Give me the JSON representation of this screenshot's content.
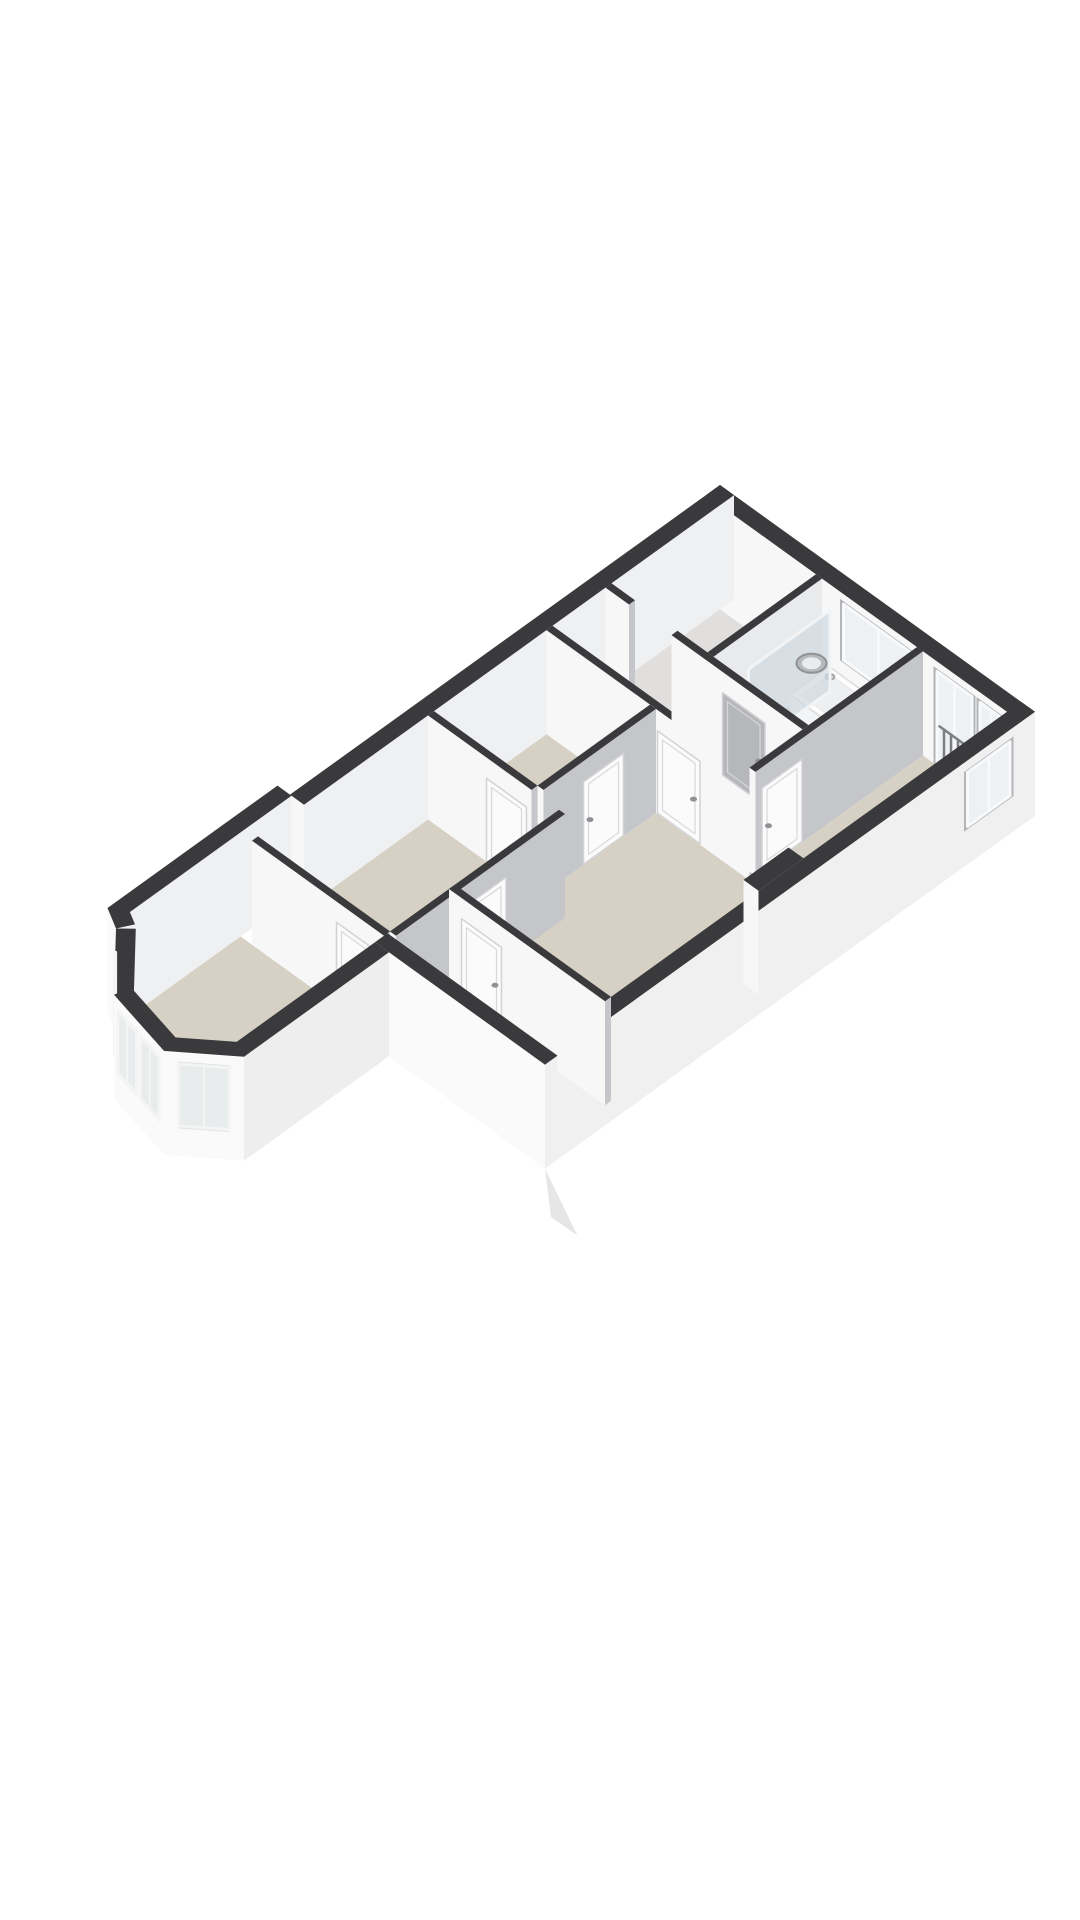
{
  "meta": {
    "type": "3d-floorplan-dollhouse-render",
    "view": "axonometric cutaway of one dwelling floor",
    "background": "#ffffff"
  },
  "palette": {
    "wall_top": "#3a3a3d",
    "wall_face_bright": "#f7f7f8",
    "wall_face_shaded": "#c5c6c9",
    "exterior_face": "#fafafa",
    "exterior_side": "#f0f0f1",
    "floor_room": "#d6d1c4",
    "floor_hall": "#e0dfdd",
    "floor_loggia": "#dadad8",
    "window_glass": "#eef1f3",
    "window_frame": "#f8f9fa",
    "window_surround": "#b4b5b8",
    "door_white": "#fbfbfc",
    "door_gray": "#b6b7ba",
    "tub_white": "#fdfdfe",
    "tub_inner": "#edeff1",
    "screen_glass": "rgba(208,217,224,0.72)"
  },
  "floorplan": {
    "projection": {
      "ox": 720,
      "oy": 589,
      "s": 50,
      "vy": 36,
      "hz": 40
    },
    "rooms": [
      {
        "id": "stairwell",
        "floor": "#e0dfdd"
      },
      {
        "id": "bathroom",
        "floor": "#d6d1c4"
      },
      {
        "id": "rear-bedroom",
        "floor": "#d6d1c4"
      },
      {
        "id": "landing-hall",
        "floor": "#e0dfdd"
      },
      {
        "id": "left-room",
        "floor": "#d6d1c4"
      },
      {
        "id": "center-bedroom",
        "floor": "#d6d1c4"
      },
      {
        "id": "front-middle-room",
        "floor": "#d6d1c4"
      },
      {
        "id": "loggia-roof-terrace",
        "floor": "#dadad8"
      },
      {
        "id": "bay-window-room",
        "floor": "#d6d1c4"
      }
    ],
    "floors": [
      {
        "id": "floor-stairwell",
        "color": "#e0dfdd",
        "pts": [
          [
            0.28,
            0.28
          ],
          [
            0.28,
            2.2
          ],
          [
            2.45,
            2.2
          ],
          [
            2.45,
            0.28
          ]
        ]
      },
      {
        "id": "floor-threshold",
        "color": "#e0dfdd",
        "pts": [
          [
            2.45,
            0.75
          ],
          [
            2.45,
            1.6
          ],
          [
            2.57,
            1.6
          ],
          [
            2.57,
            0.75
          ]
        ]
      },
      {
        "id": "floor-bathroom",
        "color": "#d6d1c4",
        "pts": [
          [
            0.28,
            2.32
          ],
          [
            0.28,
            4.22
          ],
          [
            2.45,
            4.22
          ],
          [
            2.45,
            2.32
          ]
        ]
      },
      {
        "id": "floor-rear-bedroom",
        "color": "#d6d1c4",
        "pts": [
          [
            0.28,
            4.34
          ],
          [
            0.28,
            6.02
          ],
          [
            3.63,
            6.02
          ],
          [
            3.63,
            4.34
          ]
        ]
      },
      {
        "id": "floor-hall",
        "color": "#e0dfdd",
        "pts": [
          [
            2.57,
            0.28
          ],
          [
            2.57,
            4.22
          ],
          [
            3.63,
            4.22
          ],
          [
            3.63,
            0.28
          ]
        ]
      },
      {
        "id": "floor-left-room",
        "color": "#d6d1c4",
        "pts": [
          [
            3.75,
            0.28
          ],
          [
            3.75,
            2.35
          ],
          [
            6.0,
            2.35
          ],
          [
            6.0,
            0.28
          ]
        ]
      },
      {
        "id": "floor-center-room",
        "color": "#d6d1c4",
        "pts": [
          [
            3.75,
            2.47
          ],
          [
            3.75,
            6.02
          ],
          [
            8.2,
            6.02
          ],
          [
            8.2,
            2.47
          ]
        ]
      },
      {
        "id": "floor-room-b",
        "color": "#d6d1c4",
        "pts": [
          [
            6.12,
            0.28
          ],
          [
            6.12,
            2.9
          ],
          [
            9.5,
            2.9
          ],
          [
            9.5,
            0.28
          ]
        ]
      },
      {
        "id": "floor-loggia",
        "color": "#dadad8",
        "pts": [
          [
            8.32,
            2.9
          ],
          [
            8.32,
            6.02
          ],
          [
            9.55,
            6.02
          ],
          [
            9.55,
            2.9
          ]
        ]
      },
      {
        "id": "floor-bay-room",
        "color": "#d6d1c4",
        "pts": [
          [
            9.62,
            0.03
          ],
          [
            9.62,
            2.9
          ],
          [
            12.62,
            2.9
          ],
          [
            13.18,
            2.22
          ],
          [
            12.92,
            1.1
          ],
          [
            12.1,
            0.3
          ],
          [
            11.9,
            0.03
          ]
        ]
      }
    ],
    "walls": [
      {
        "id": "wall-rear",
        "u": [
          0,
          0.28
        ],
        "v": [
          0,
          6.3
        ],
        "top": "#3a3a3d",
        "faceU": "#f7f7f8",
        "faceV": "#f0f0f1",
        "windows": [
          {
            "face": "u",
            "a": [
              2.75,
              4.15
            ],
            "z": [
              0.95,
              2.35
            ],
            "type": "window",
            "name": "bathroom-window"
          },
          {
            "face": "u",
            "a": [
              4.62,
              5.32
            ],
            "z": [
              0.05,
              2.35
            ],
            "type": "french-door",
            "name": "balcony-door"
          },
          {
            "face": "u",
            "a": [
              5.48,
              5.92
            ],
            "z": [
              0.95,
              2.35
            ],
            "type": "window",
            "name": "bedroom-window"
          }
        ]
      },
      {
        "id": "wall-left-rear",
        "u": [
          0,
          8.6
        ],
        "v": [
          0,
          0.28
        ],
        "top": "#3a3a3d",
        "faceU": "#f7f7f8",
        "faceV": "#eff0f1"
      },
      {
        "id": "wall-left-front",
        "u": [
          8.6,
          12.0
        ],
        "v": [
          -0.25,
          0.03
        ],
        "top": "#3a3a3d",
        "faceU": "#f7f7f8",
        "faceV": "#eff0f1"
      },
      {
        "id": "wall-divider-stairs-bath",
        "u": [
          0.28,
          2.45
        ],
        "v": [
          2.2,
          2.32
        ],
        "top": "#3a3a3d",
        "faceU": "#f7f7f8",
        "faceV": "#e9eaeb"
      },
      {
        "id": "wall-hall-rear-left",
        "u": [
          2.45,
          2.57
        ],
        "v": [
          0.28,
          0.75
        ],
        "top": "#3a3a3d",
        "faceU": "#f7f7f8",
        "faceV": "#c5c6c9"
      },
      {
        "id": "wall-hall-rear-right",
        "u": [
          2.45,
          2.57
        ],
        "v": [
          1.6,
          4.22
        ],
        "top": "#3a3a3d",
        "faceU": "#f7f7f8",
        "faceV": "#c5c6c9",
        "doors": [
          {
            "face": "u",
            "a": [
              2.62,
              3.47
            ],
            "color": "#b6b7ba",
            "name": "bathroom-door"
          }
        ]
      },
      {
        "id": "wall-hall-front",
        "u": [
          3.63,
          3.75
        ],
        "v": [
          0.28,
          4.34
        ],
        "top": "#3a3a3d",
        "faceU": "#f7f7f8",
        "faceV": "#c5c6c9",
        "doors": [
          {
            "face": "u",
            "a": [
              2.5,
              3.35
            ],
            "color": "#fbfbfc",
            "name": "center-room-door"
          }
        ]
      },
      {
        "id": "wall-bath-bedroom",
        "u": [
          0.28,
          3.63
        ],
        "v": [
          4.22,
          4.34
        ],
        "top": "#3a3a3d",
        "faceU": "#f7f7f8",
        "faceV": "#c5c6c9",
        "doors": [
          {
            "face": "v",
            "a": [
              2.7,
              3.5
            ],
            "color": "#fbfbfc",
            "name": "rear-bedroom-door"
          }
        ]
      },
      {
        "id": "wall-right",
        "u": [
          0,
          9.8
        ],
        "v": [
          6.02,
          6.3
        ],
        "top": "#3a3a3d",
        "faceU": "#fafafa",
        "faceV": "#f0f0f1",
        "windows": [
          {
            "face": "v",
            "a": [
              0.5,
              1.35
            ],
            "z": [
              0.95,
              2.3
            ],
            "type": "window",
            "name": "side-window"
          }
        ]
      },
      {
        "id": "wall-leftroom-center",
        "u": [
          3.75,
          6.0
        ],
        "v": [
          2.35,
          2.47
        ],
        "top": "#3a3a3d",
        "faceU": "#f7f7f8",
        "faceV": "#c5c6c9",
        "doors": [
          {
            "face": "v",
            "a": [
              4.4,
              5.2
            ],
            "color": "#fbfbfc",
            "name": "left-room-door"
          }
        ]
      },
      {
        "id": "wall-leftroom-roomb",
        "u": [
          6.0,
          6.12
        ],
        "v": [
          0.28,
          2.35
        ],
        "top": "#3a3a3d",
        "faceU": "#f7f7f8",
        "faceV": "#c5c6c9",
        "doors": [
          {
            "face": "u",
            "a": [
              1.45,
              2.25
            ],
            "color": "#fbfbfc",
            "name": "front-middle-room-door"
          }
        ]
      },
      {
        "id": "wall-roomb-center",
        "u": [
          6.12,
          9.5
        ],
        "v": [
          2.9,
          3.02
        ],
        "top": "#3a3a3d",
        "faceU": "#f7f7f8",
        "faceV": "#c5c6c9",
        "doors": [
          {
            "face": "v",
            "a": [
              7.3,
              8.1
            ],
            "color": "#fbfbfc",
            "name": "connecting-door"
          }
        ]
      },
      {
        "id": "wall-roomb-bay",
        "u": [
          9.5,
          9.62
        ],
        "v": [
          0.26,
          2.9
        ],
        "top": "#3a3a3d",
        "faceU": "#f7f7f8",
        "faceV": "#c5c6c9",
        "doors": [
          {
            "face": "u",
            "a": [
              1.95,
              2.75
            ],
            "color": "#fbfbfc",
            "name": "bay-room-door"
          }
        ]
      },
      {
        "id": "chimney-breast",
        "u": [
          4.35,
          5.25
        ],
        "v": [
          5.72,
          6.02
        ],
        "top": "#3a3a3d",
        "faceU": "#f7f7f8",
        "faceV": null
      },
      {
        "id": "wall-center-front",
        "u": [
          8.2,
          8.32
        ],
        "v": [
          2.9,
          6.02
        ],
        "top": "#3a3a3d",
        "faceU": "#f7f7f8",
        "faceV": "#c5c6c9",
        "doors": [
          {
            "face": "u",
            "a": [
              3.15,
              3.95
            ],
            "color": "#fbfbfc",
            "name": "loggia-door"
          }
        ]
      },
      {
        "id": "wall-front-loggia",
        "u": [
          9.55,
          9.8
        ],
        "v": [
          2.9,
          6.3
        ],
        "top": "#3a3a3d",
        "faceU": "#fafafa",
        "faceV": "#f0f0f1"
      },
      {
        "id": "wall-bay-right",
        "u": [
          9.8,
          12.7
        ],
        "v": [
          2.9,
          3.18
        ],
        "top": "#3a3a3d",
        "faceU": "#fafafa",
        "faceV": "#eeeeef"
      }
    ],
    "bay_segments": [
      {
        "id": "bay-face-right",
        "a": [
          12.7,
          3.18
        ],
        "b": [
          13.42,
          2.3
        ],
        "t": 0.28,
        "top": "#3a3a3d",
        "face": "#fafafa",
        "windows": [
          [
            0.18,
            0.82
          ]
        ]
      },
      {
        "id": "bay-face-front",
        "a": [
          13.42,
          2.3
        ],
        "b": [
          13.14,
          1.02
        ],
        "t": 0.28,
        "top": "#3a3a3d",
        "face": "#fafafa",
        "windows": [
          [
            0.1,
            0.47
          ],
          [
            0.55,
            0.92
          ]
        ]
      },
      {
        "id": "bay-face-left",
        "a": [
          13.14,
          1.02
        ],
        "b": [
          12.2,
          0.12
        ],
        "t": 0.28,
        "top": "#3a3a3d",
        "face": "#fafafa",
        "windows": [
          [
            0.18,
            0.82
          ]
        ]
      },
      {
        "id": "bay-face-corner",
        "a": [
          12.2,
          0.12
        ],
        "b": [
          12.0,
          -0.25
        ],
        "t": 0.28,
        "top": "#3a3a3d",
        "face": "#fafafa",
        "windows": []
      }
    ],
    "bay_window_z": [
      0.75,
      2.3
    ],
    "fixtures": [
      {
        "id": "bathtub",
        "type": "tub",
        "order": 2.74,
        "u": [
          0.32,
          1.1
        ],
        "v": [
          2.5,
          4.18
        ],
        "rim": "#fdfdfe",
        "inner": "#edeff1",
        "side": "#f3f4f5",
        "edge": "#dfe0e2"
      },
      {
        "id": "bath-faucet",
        "type": "dot",
        "order": 2.78,
        "u": 0.52,
        "v": 2.72,
        "z": 0.72,
        "r": 4.5,
        "fill": "#c7c8ca",
        "stroke": "#9fa0a3"
      },
      {
        "id": "shower-screen",
        "type": "screen",
        "order": 2.8,
        "v": 2.52,
        "u": [
          0.32,
          1.95
        ],
        "h": 2.02,
        "fill": "rgba(208,217,224,0.72)",
        "frame": "#f2f3f4"
      },
      {
        "id": "wash-basin",
        "type": "basin",
        "order": 2.92,
        "u": 0.6,
        "v": 2.43,
        "z": 0.87,
        "outer": "#b7babc",
        "ring": "#8f9194",
        "inner": "#e9ebec"
      },
      {
        "id": "roof-wedge",
        "type": "poly3",
        "order": 16,
        "pts": [
          [
            9.8,
            6.3,
            0
          ],
          [
            9.85,
            7.0,
            -1.0
          ],
          [
            9.8,
            6.42,
            -1.1
          ]
        ],
        "fill": "#e6e6e6"
      }
    ]
  }
}
